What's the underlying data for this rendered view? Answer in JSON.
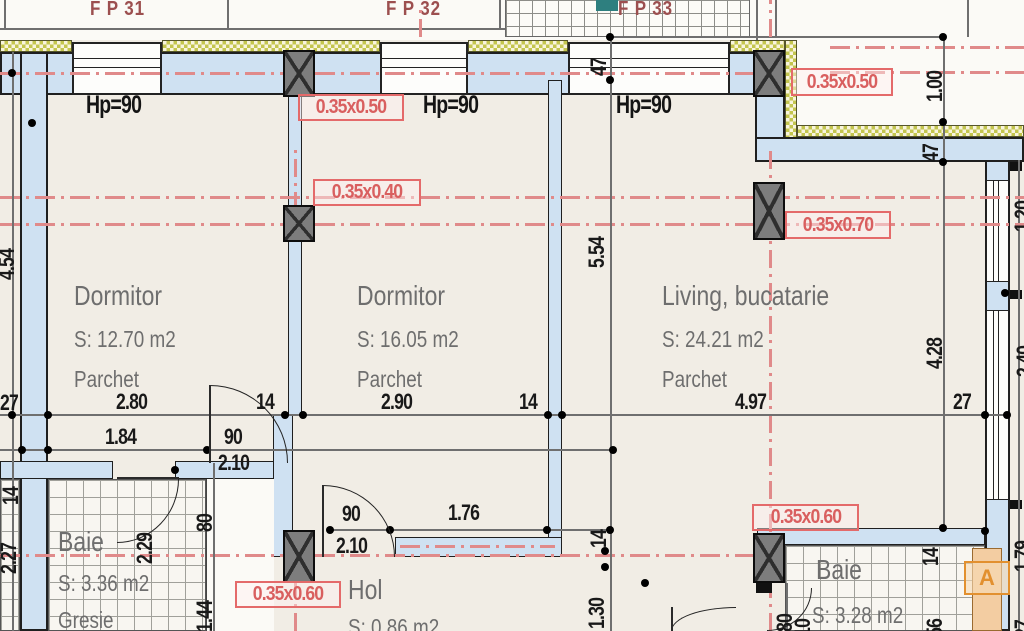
{
  "drawing": {
    "type": "apartment floor plan"
  },
  "colors": {
    "wall_fill": "#cfe1f2",
    "axis_red": "#e08a8a",
    "beam_label_red": "#d95f5f",
    "insulation_yellow": "#c3c54e",
    "window_tag_red": "#9c4f4f",
    "section_orange": "#e2902f",
    "room_text_gray": "#6e6e6e"
  },
  "window_tags": {
    "fp31": "F P 31",
    "fp32": "F P 32",
    "fp33": "F P 33"
  },
  "parapets": {
    "hp1": "Hp=90",
    "hp2": "Hp=90",
    "hp3": "Hp=90"
  },
  "rooms": {
    "dormitor1": {
      "name": "Dormitor",
      "area": "S: 12.70 m2",
      "floor": "Parchet"
    },
    "dormitor2": {
      "name": "Dormitor",
      "area": "S: 16.05 m2",
      "floor": "Parchet"
    },
    "living": {
      "name": "Living, bucatarie",
      "area": "S: 24.21 m2",
      "floor": "Parchet"
    },
    "baie_left": {
      "name": "Baie",
      "area": "S: 3.36 m2",
      "floor": "Gresie"
    },
    "hol": {
      "name": "Hol",
      "area": "S: 0.86 m2"
    },
    "baie_right": {
      "name": "Baie",
      "area": "S: 3.28 m2"
    }
  },
  "beams": {
    "top_mid": "0.35x0.50",
    "mid_left": "0.35x0.40",
    "top_right": "0.35x0.50",
    "right": "0.35x0.70",
    "bottom_left": "0.35x0.60",
    "bottom_right": "0.35x0.60"
  },
  "dims": {
    "w_280": "2.80",
    "t_14a": "14",
    "w_290": "2.90",
    "t_14b": "14",
    "w_497": "4.97",
    "t_27a": "27",
    "w_184": "1.84",
    "d_90a": "90",
    "d_210a": "2.10",
    "d_90b": "90",
    "d_210b": "2.10",
    "w_176": "1.76",
    "v_47a": "47",
    "v_554": "5.54",
    "v_14a": "14",
    "v_130": "1.30",
    "v_100": "1.00",
    "v_47b": "47",
    "v_428": "4.28",
    "v_14b": "14",
    "v_156": "1.56",
    "v_80a": "80",
    "v_144": "1.44",
    "v_229": "2.29",
    "v_227": "2.27",
    "v_454": "4.54",
    "h_27b": "27",
    "v_14c": "14",
    "v_80b": "80",
    "v_210c": "2.10",
    "v_120": "1.20",
    "v_240": "2.40",
    "v_179": "1.79",
    "v_27c": "27"
  },
  "markers": {
    "section": "A"
  }
}
